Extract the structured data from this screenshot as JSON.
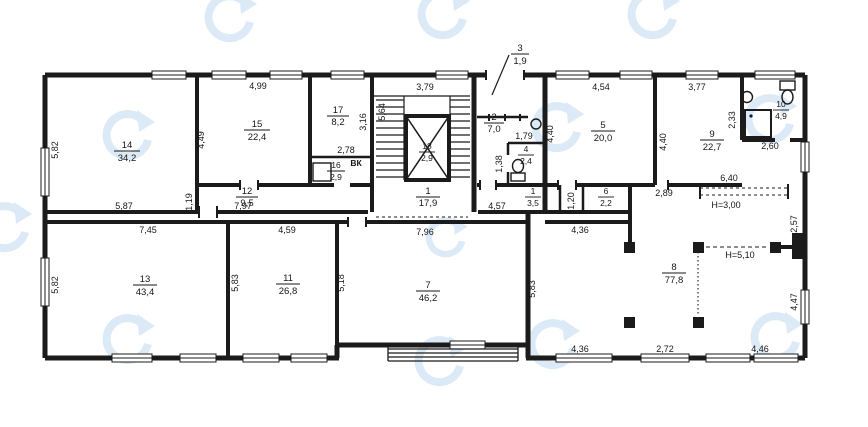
{
  "plan": {
    "rooms": {
      "r1": {
        "num": "1",
        "area": "17,9"
      },
      "r1b": {
        "num": "1",
        "area": "3,5"
      },
      "r2": {
        "num": "2",
        "area": "7,0"
      },
      "r3": {
        "num": "3",
        "area": "1,9"
      },
      "r4": {
        "num": "4",
        "area": "2,4"
      },
      "r5": {
        "num": "5",
        "area": "20,0"
      },
      "r6": {
        "num": "6",
        "area": "2,2"
      },
      "r7": {
        "num": "7",
        "area": "46,2"
      },
      "r8": {
        "num": "8",
        "area": "77,8"
      },
      "r9": {
        "num": "9",
        "area": "22,7"
      },
      "r10": {
        "num": "10",
        "area": "4,9"
      },
      "r11": {
        "num": "11",
        "area": "26,8"
      },
      "r12": {
        "num": "12",
        "area": "9,5"
      },
      "r13": {
        "num": "13",
        "area": "43,4"
      },
      "r14": {
        "num": "14",
        "area": "34,2"
      },
      "r15": {
        "num": "15",
        "area": "22,4"
      },
      "r16": {
        "num": "16",
        "area": "2,9"
      },
      "r17": {
        "num": "17",
        "area": "8,2"
      },
      "lift": {
        "num": "18",
        "area": "2,9"
      }
    },
    "annotations": {
      "vk": "ВК",
      "h300": "H=3,00",
      "h510": "H=5,10"
    },
    "dims": {
      "t1": "4,99",
      "t2": "3,79",
      "t3": "4,54",
      "t4": "3,77",
      "l1": "5,82",
      "l2": "5,82",
      "v449": "4,49",
      "v316": "3,16",
      "v564": "5,64",
      "h278": "2,78",
      "h179": "1,79",
      "v440a": "4,40",
      "v440b": "4,40",
      "v233": "2,33",
      "h260": "2,60",
      "h640": "6,40",
      "h289": "2,89",
      "v119": "1,19",
      "v138": "1,38",
      "h587": "5,87",
      "h797": "7,97",
      "h457": "4,57",
      "v120": "1,20",
      "h436a": "4,36",
      "h745": "7,45",
      "h459": "4,59",
      "h796": "7,96",
      "v583a": "5,83",
      "v518": "5,18",
      "v583b": "5,83",
      "v257": "2,57",
      "v447": "4,47",
      "h436b": "4,36",
      "h272": "2,72",
      "h446": "4,46"
    },
    "colors": {
      "line": "#1b1b1b",
      "watermark": "#bdd9ee"
    }
  }
}
